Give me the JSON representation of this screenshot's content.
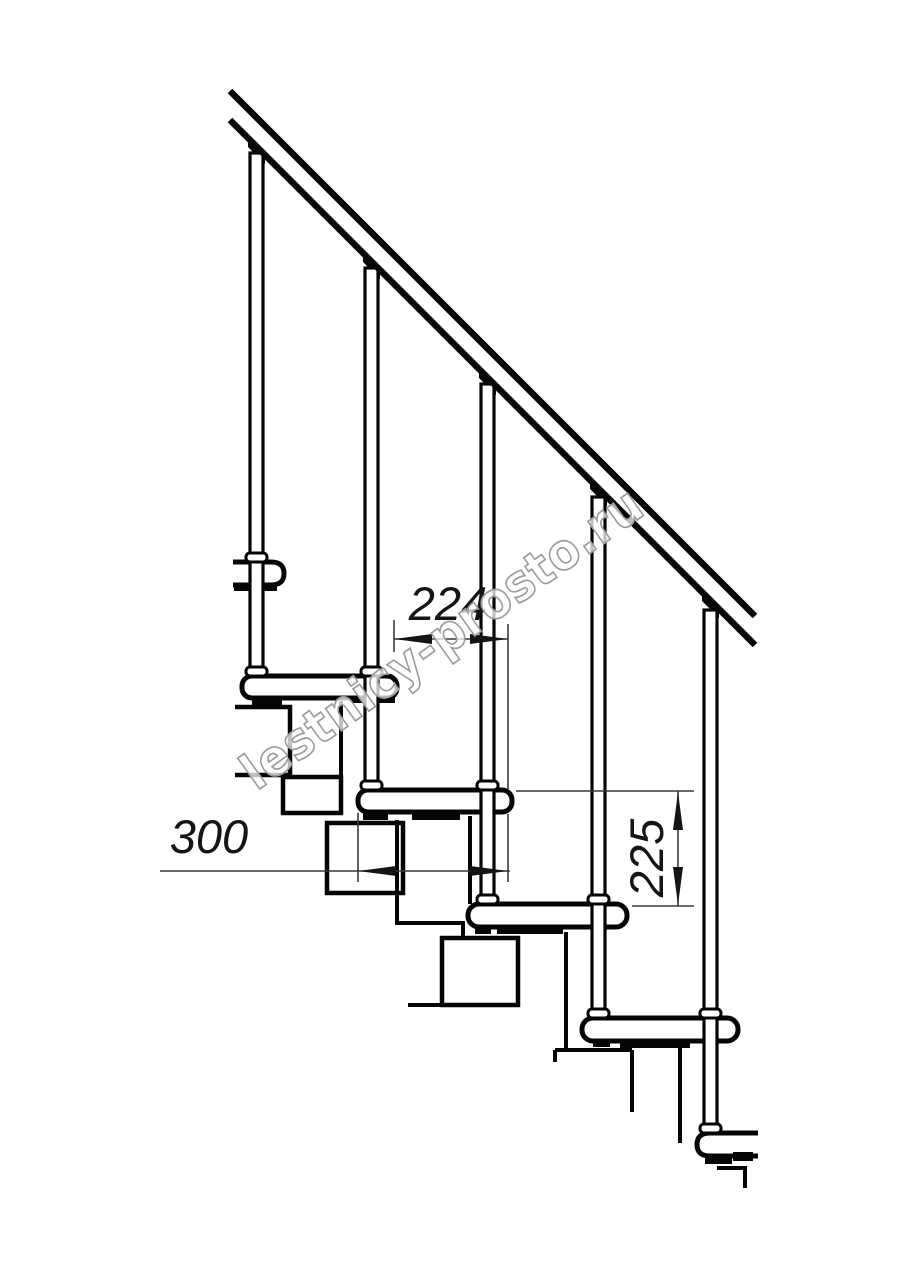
{
  "dimensions": {
    "run": "224",
    "tread_depth": "300",
    "rise": "225"
  },
  "watermark": "lestnicy-prosto.ru",
  "colors": {
    "line": "#050505",
    "dimension_line": "#3a3a3a",
    "dimension_text": "#151515",
    "watermark_outline": "#9c9c9c",
    "background": "#ffffff"
  }
}
